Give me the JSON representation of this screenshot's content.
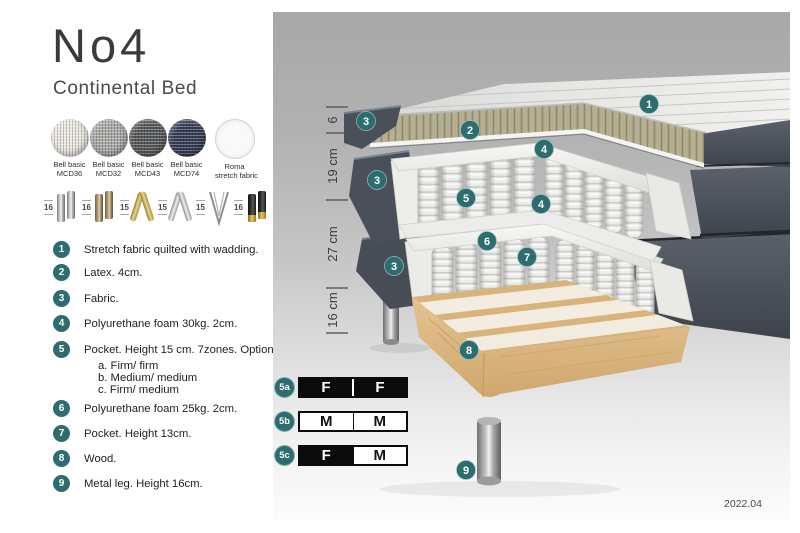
{
  "header": {
    "title": "No4",
    "subtitle": "Continental Bed"
  },
  "fabrics": [
    {
      "line1": "Bell basic",
      "line2": "MCD36",
      "color": "#eae7e0"
    },
    {
      "line1": "Bell basic",
      "line2": "MCD32",
      "color": "#a9a9a7"
    },
    {
      "line1": "Bell basic",
      "line2": "MCD43",
      "color": "#56585a"
    },
    {
      "line1": "Bell basic",
      "line2": "MCD74",
      "color": "#363c55"
    },
    {
      "line1": "Roma",
      "line2": "stretch fabric",
      "color": "#f9f9f9"
    }
  ],
  "legs": [
    {
      "height": "16",
      "style": "cylinder-silver"
    },
    {
      "height": "16",
      "style": "cylinder-bronze"
    },
    {
      "height": "15",
      "style": "twisted-gold"
    },
    {
      "height": "15",
      "style": "twisted-silver"
    },
    {
      "height": "15",
      "style": "hairpin-metal"
    },
    {
      "height": "16",
      "style": "cylinder-black-gold"
    }
  ],
  "list": [
    {
      "num": "1",
      "text": "Stretch fabric quilted with wadding."
    },
    {
      "num": "2",
      "text": "Latex. 4cm."
    },
    {
      "num": "3",
      "text": "Fabric."
    },
    {
      "num": "4",
      "text": "Polyurethane foam 30kg. 2cm."
    },
    {
      "num": "5",
      "text": "Pocket. Height 15 cm. 7zones. Option:",
      "options": [
        "a. Firm/ firm",
        "b. Medium/ medium",
        "c. Firm/ medium"
      ]
    },
    {
      "num": "6",
      "text": "Polyurethane foam 25kg. 2cm."
    },
    {
      "num": "7",
      "text": "Pocket. Height 13cm."
    },
    {
      "num": "8",
      "text": "Wood."
    },
    {
      "num": "9",
      "text": "Metal leg. Height 16cm."
    }
  ],
  "diagram": {
    "badges": [
      "1",
      "2",
      "3",
      "4",
      "3",
      "5",
      "4",
      "6",
      "3",
      "7",
      "8",
      "9"
    ],
    "dimensions": [
      "6",
      "19 cm",
      "27 cm",
      "16 cm"
    ],
    "version": "2022.04"
  },
  "firmness": [
    {
      "id": "5a",
      "cells": [
        {
          "letter": "F",
          "filled": true
        },
        {
          "letter": "F",
          "filled": true
        }
      ]
    },
    {
      "id": "5b",
      "cells": [
        {
          "letter": "M",
          "filled": false
        },
        {
          "letter": "M",
          "filled": false
        }
      ]
    },
    {
      "id": "5c",
      "cells": [
        {
          "letter": "F",
          "filled": true
        },
        {
          "letter": "M",
          "filled": false
        }
      ]
    }
  ],
  "colors": {
    "badge_teal": "#2d6c6f",
    "upholstery_gray": "#4a505a",
    "latex_olive": "#b6b093",
    "wood_tan": "#ddbb86",
    "panel_top": "#a8a8a8",
    "panel_bottom": "#fbfbfb",
    "firm_filled": "#0b0b0b"
  }
}
